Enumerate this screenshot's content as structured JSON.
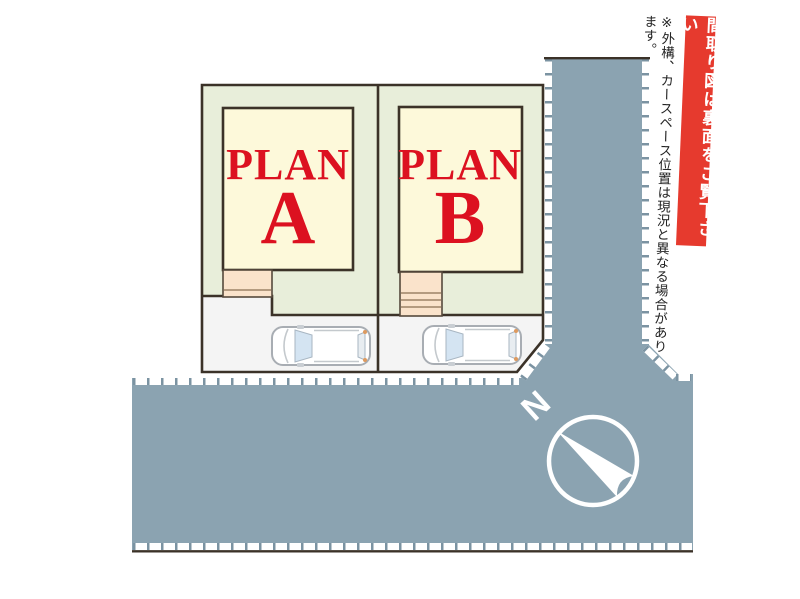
{
  "page": {
    "background": "#ffffff"
  },
  "plans": [
    {
      "label_line1": "PLAN",
      "label_line2": "A"
    },
    {
      "label_line1": "PLAN",
      "label_line2": "B"
    }
  ],
  "side_banner": {
    "text": "間取り図は裏面をご覧下さい"
  },
  "side_note": {
    "text": "※外構、カースペース位置は現況と異なる場合があります。"
  },
  "compass": {
    "north_label": "N"
  },
  "colors": {
    "page_bg": "#ffffff",
    "road": "#8ba3b1",
    "road_tick": "#7b93a2",
    "lot_green": "#e8eeda",
    "building_yellow": "#fdf9da",
    "porch_peach": "#fae3cb",
    "outline_dark": "#3b3228",
    "plan_red": "#dc1120",
    "banner_red": "#e63a2e",
    "car_blue_glass": "#d4e4f2"
  }
}
